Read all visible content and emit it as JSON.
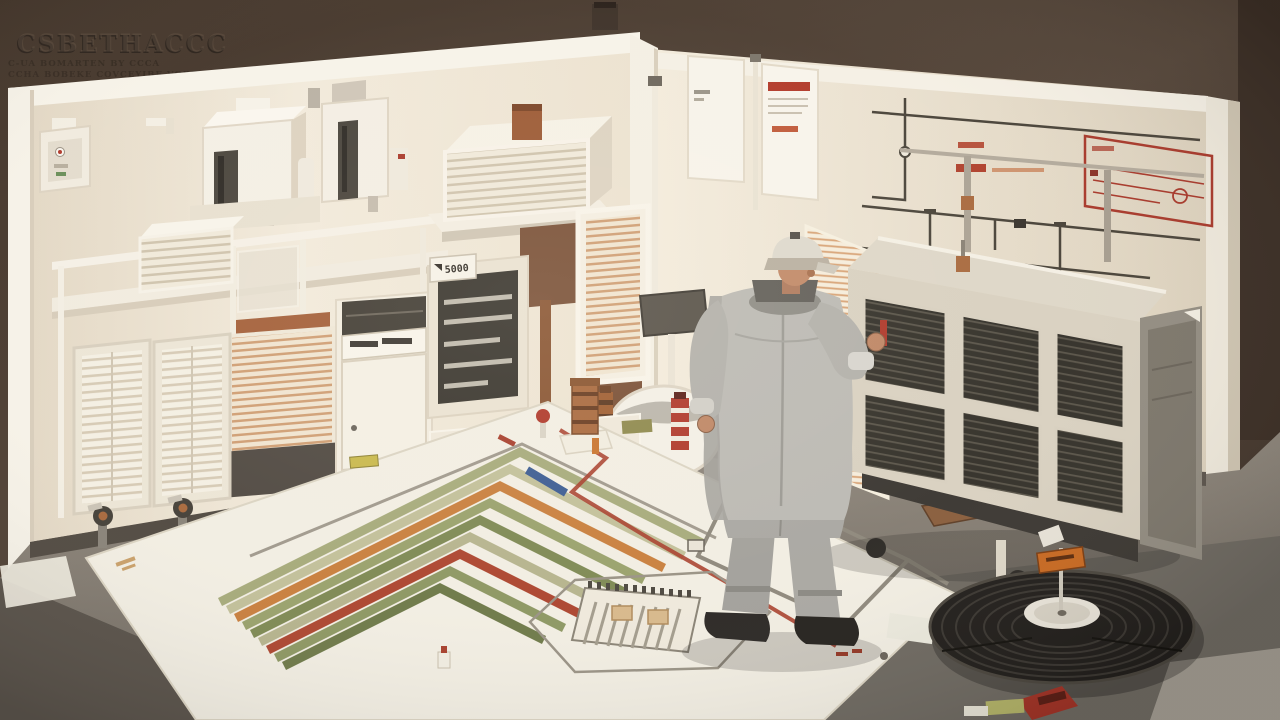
{
  "scene": {
    "type": "isometric 3D illustration",
    "setting": "HVAC and electrical equipment workshop diorama with technician",
    "embossed_title": "CSBETHACCC",
    "embossed_subtitle_line1": "C-UA BOMARTEN  BY  CCCA",
    "embossed_subtitle_line2": "CCHA BOBEKE COVCEYIBE VOBE",
    "display_tab_label": "5000",
    "figure_description": "technician in gray coveralls and cap seen from behind"
  },
  "palette": {
    "background_brown": "#4b3b30",
    "background_brown_dark": "#332822",
    "wall_cream": "#f0e7d7",
    "frame_white": "#f8f4ea",
    "floor_gray": "#8a8278",
    "floor_dark": "#5c554d",
    "mat_white": "#f2eee3",
    "grille_dark": "#35322b",
    "accent_red": "#b0422e",
    "accent_orange": "#c9803f",
    "trace_olive": "#8f9864",
    "trace_blue": "#3d5d93",
    "copper": "#a96a3f",
    "uniform_gray": "#bcbab3",
    "coil_black": "#221f1c"
  },
  "objects": {
    "technician": "technician-figure",
    "hvac_unit": "hvac-filter-unit",
    "coil": "condenser-coil-disc",
    "mat": "floor-schematic-mat",
    "wall_diagram": "wall-piping-diagram",
    "louver_unit": "louver-vent-unit",
    "heaters": "wall-heater-units",
    "slot_panels": "slot-rack-panels",
    "radiator": "radiator-cabinet",
    "display_cabinet": "glass-display-cabinet",
    "posters": "wall-posters",
    "valves": "valve-assemblies"
  }
}
